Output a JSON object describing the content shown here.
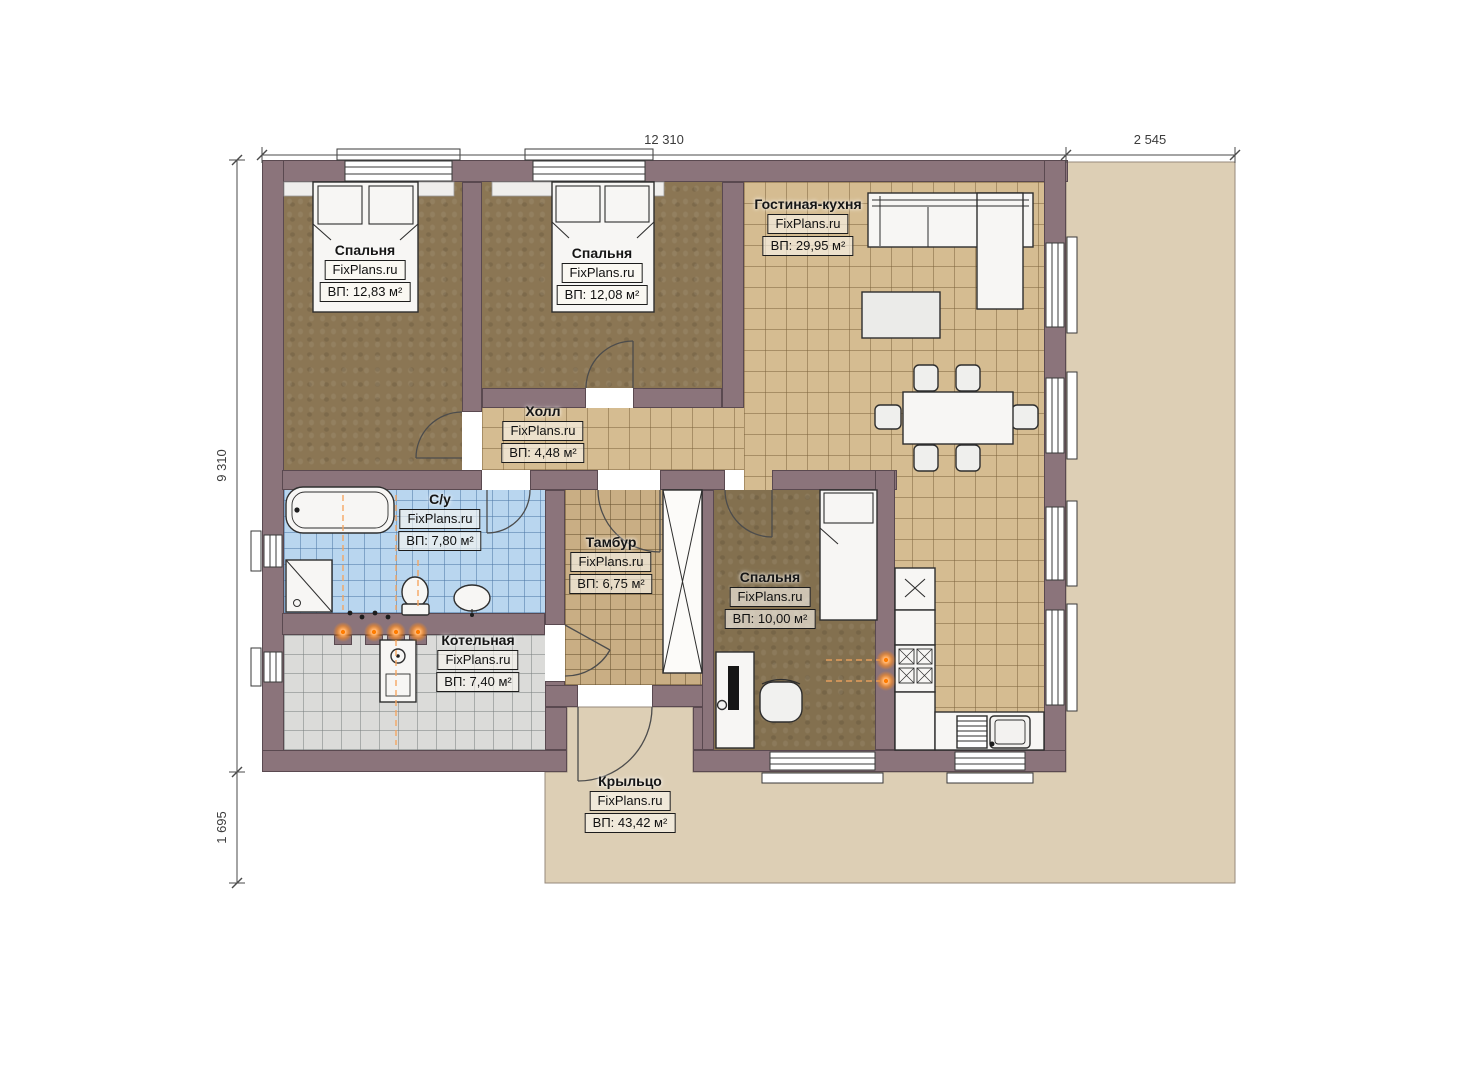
{
  "brand": {
    "watermark": "FixPlans.ru"
  },
  "dims": {
    "top_main": "12 310",
    "top_right": "2 545",
    "left_main": "9 310",
    "left_lower": "1 695"
  },
  "rooms": {
    "bedroom1": {
      "name": "Спальня",
      "area": "ВП: 12,83 м²"
    },
    "bedroom2": {
      "name": "Спальня",
      "area": "ВП: 12,08 м²"
    },
    "living": {
      "name": "Гостиная-кухня",
      "area": "ВП: 29,95 м²"
    },
    "hall": {
      "name": "Холл",
      "area": "ВП: 4,48 м²"
    },
    "bathroom": {
      "name": "С/у",
      "area": "ВП: 7,80 м²"
    },
    "tambur": {
      "name": "Тамбур",
      "area": "ВП: 6,75 м²"
    },
    "bedroom3": {
      "name": "Спальня",
      "area": "ВП: 10,00 м²"
    },
    "boiler": {
      "name": "Котельная",
      "area": "ВП: 7,40 м²"
    },
    "porch": {
      "name": "Крыльцо",
      "area": "ВП: 43,42 м²"
    }
  },
  "colors": {
    "wall": "#8b747b",
    "wood_floor": "#8b7654",
    "tile_tan": "#d5bc91",
    "tile_tambur": "#c9ae84",
    "tile_blue": "#b9d6ef",
    "tile_gray": "#dbdbd9",
    "porch": "#ddcfb5",
    "heat_orange": "#ff8a1a"
  }
}
